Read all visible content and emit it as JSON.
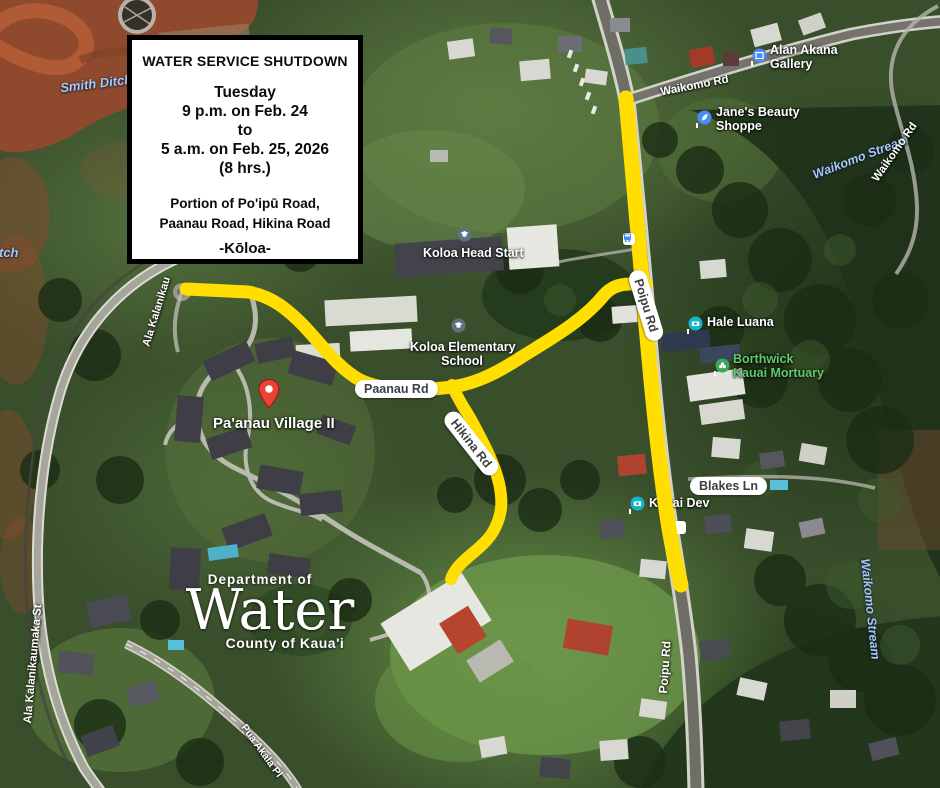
{
  "notice": {
    "title": "WATER SERVICE SHUTDOWN",
    "date_lines": [
      "Tuesday",
      "9 p.m. on Feb. 24",
      "to",
      "5 a.m. on Feb. 25, 2026",
      "(8 hrs.)"
    ],
    "area_lines": [
      "Portion of Po'ipū Road,",
      "Paanau Road, Hikina Road"
    ],
    "town": "-Kōloa-"
  },
  "logo": {
    "department": "Department of",
    "name": "Water",
    "county": "County of Kaua'i"
  },
  "map_labels": {
    "roads": {
      "waikomo_top": "Waikomo Rd",
      "waikomo_right": "Waikomo Rd",
      "ala_upper": "Ala Kalanikau",
      "ala_street": "Ala Kalanikaumaka St",
      "poipu_bottom": "Poipu Rd",
      "pua_akala": "Pua Akala Pl"
    },
    "water": {
      "smith_ditch": "Smith Ditch",
      "ditch": "Ditch",
      "stream_top": "Waikomo Stream",
      "stream_bottom": "Waikomo Stream"
    },
    "pills": {
      "paanau": "Paanau Rd",
      "hikina": "Hikina Rd",
      "poipu": "Poipu Rd",
      "blakes": "Blakes Ln"
    }
  },
  "pois": {
    "alan_akana": {
      "line1": "Alan Akana",
      "line2": "Gallery"
    },
    "janes": {
      "line1": "Jane's Beauty",
      "line2": "Shoppe"
    },
    "koloa_head_start": {
      "name": "Koloa Head Start"
    },
    "koloa_elementary": {
      "line1": "Koloa Elementary",
      "line2": "School"
    },
    "hale_luana": {
      "name": "Hale Luana"
    },
    "borthwick": {
      "line1": "Borthwick",
      "line2": "Kauai Mortuary"
    },
    "kauai_dev": {
      "name": "Kauai Dev"
    },
    "paanau_village": {
      "name": "Pa'anau Village II"
    }
  },
  "colors": {
    "route_highlight": "#FFDE00",
    "poi_blue": "#4A8CF7",
    "poi_teal": "#13B5CB",
    "poi_green": "#3DA85A",
    "poi_school": "#5F7280",
    "water_label": "#A6C6F5"
  }
}
